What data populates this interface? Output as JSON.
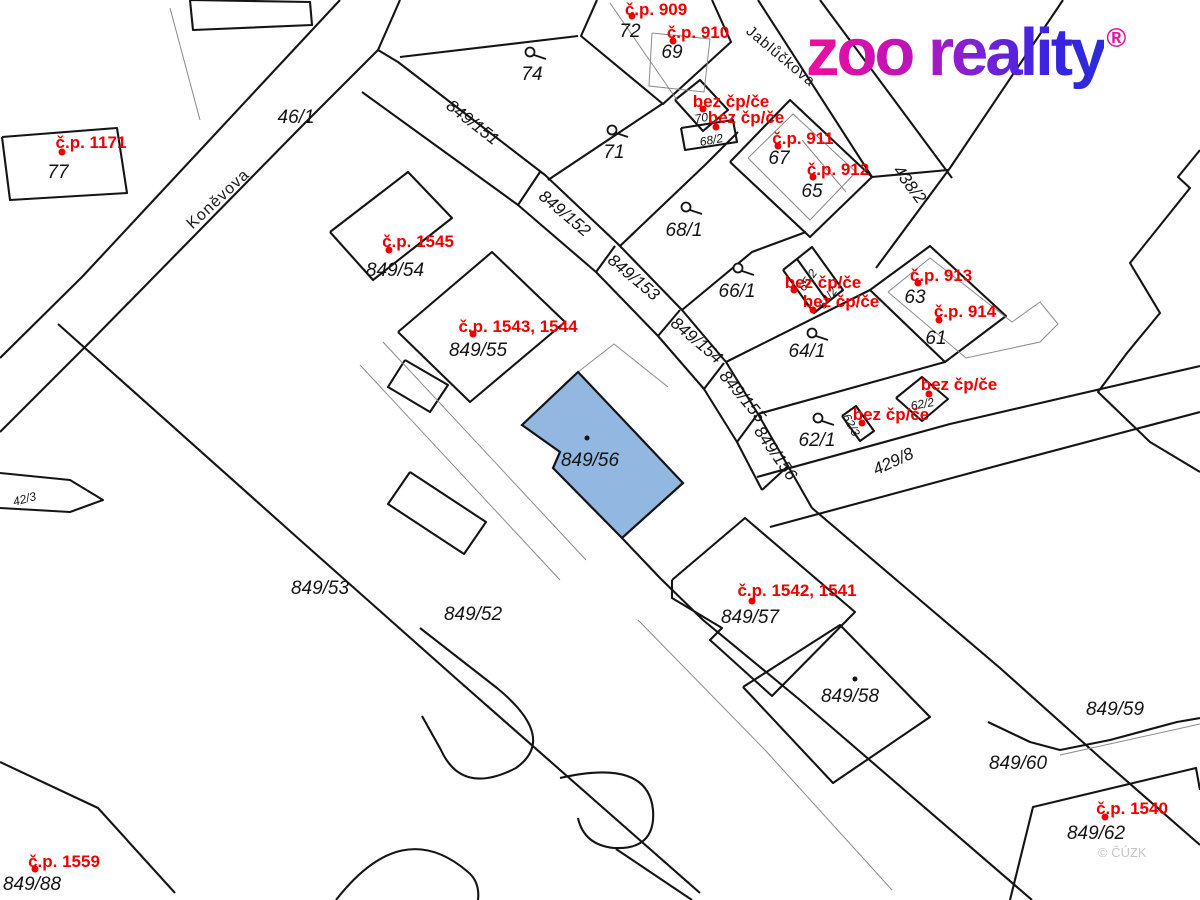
{
  "logo": {
    "text": "zoo reality",
    "reg": "®"
  },
  "watermark": "© ČÚZK",
  "highlight": {
    "label": "849/56",
    "color": "#92b7e0",
    "points": [
      [
        578,
        372
      ],
      [
        683,
        483
      ],
      [
        622,
        538
      ],
      [
        553,
        468
      ],
      [
        560,
        452
      ],
      [
        522,
        425
      ]
    ],
    "dot": [
      587,
      438
    ],
    "label_pos": [
      590,
      459
    ]
  },
  "streets": [
    {
      "name": "Koněvova",
      "x": 218,
      "y": 199,
      "rot": -43,
      "size": 16
    },
    {
      "name": "Jablůčkova",
      "x": 781,
      "y": 56,
      "rot": 40,
      "size": 15
    }
  ],
  "parcel_labels": [
    {
      "t": "77",
      "x": 58,
      "y": 172
    },
    {
      "t": "46/1",
      "x": 296,
      "y": 117
    },
    {
      "t": "74",
      "x": 532,
      "y": 74
    },
    {
      "t": "72",
      "x": 630,
      "y": 31
    },
    {
      "t": "69",
      "x": 672,
      "y": 52
    },
    {
      "t": "71",
      "x": 614,
      "y": 152
    },
    {
      "t": "68/1",
      "x": 684,
      "y": 230
    },
    {
      "t": "66/1",
      "x": 737,
      "y": 291
    },
    {
      "t": "67",
      "x": 779,
      "y": 158
    },
    {
      "t": "65",
      "x": 812,
      "y": 191
    },
    {
      "t": "64/1",
      "x": 807,
      "y": 351
    },
    {
      "t": "63",
      "x": 915,
      "y": 297
    },
    {
      "t": "61",
      "x": 936,
      "y": 338
    },
    {
      "t": "62/1",
      "x": 817,
      "y": 440
    },
    {
      "t": "849/54",
      "x": 395,
      "y": 270
    },
    {
      "t": "849/55",
      "x": 478,
      "y": 350
    },
    {
      "t": "849/53",
      "x": 320,
      "y": 588
    },
    {
      "t": "849/52",
      "x": 473,
      "y": 614
    },
    {
      "t": "849/57",
      "x": 750,
      "y": 617
    },
    {
      "t": "849/58",
      "x": 850,
      "y": 696
    },
    {
      "t": "849/59",
      "x": 1115,
      "y": 709
    },
    {
      "t": "849/60",
      "x": 1018,
      "y": 763
    },
    {
      "t": "849/62",
      "x": 1096,
      "y": 833
    },
    {
      "t": "849/88",
      "x": 32,
      "y": 884
    },
    {
      "t": "849/151",
      "x": 473,
      "y": 122,
      "rot": 38,
      "size": 17
    },
    {
      "t": "849/152",
      "x": 565,
      "y": 213,
      "rot": 40,
      "size": 17
    },
    {
      "t": "849/153",
      "x": 634,
      "y": 277,
      "rot": 40,
      "size": 17
    },
    {
      "t": "849/154",
      "x": 697,
      "y": 340,
      "rot": 40,
      "size": 17
    },
    {
      "t": "849/155",
      "x": 743,
      "y": 396,
      "rot": 50,
      "size": 17
    },
    {
      "t": "849/156",
      "x": 776,
      "y": 453,
      "rot": 55,
      "size": 17
    },
    {
      "t": "438/2",
      "x": 910,
      "y": 184,
      "rot": 53,
      "size": 17
    },
    {
      "t": "429/8",
      "x": 893,
      "y": 461,
      "rot": -25,
      "size": 17
    },
    {
      "t": "70",
      "x": 701,
      "y": 116,
      "rot": -10,
      "size": 12
    },
    {
      "t": "68/2",
      "x": 711,
      "y": 138,
      "rot": -10,
      "size": 12
    },
    {
      "t": "65/2",
      "x": 806,
      "y": 279,
      "rot": -55,
      "size": 12
    },
    {
      "t": "64/2",
      "x": 826,
      "y": 297,
      "rot": -55,
      "size": 12
    },
    {
      "t": "62/2",
      "x": 922,
      "y": 402,
      "rot": -10,
      "size": 12
    },
    {
      "t": "62/3",
      "x": 853,
      "y": 424,
      "rot": 62,
      "size": 12
    },
    {
      "t": "42/3",
      "x": 24,
      "y": 497,
      "rot": -15,
      "size": 12
    }
  ],
  "red_labels": [
    {
      "t": "č.p. 1171",
      "x": 91,
      "y": 142,
      "dx": 62,
      "dy": 152
    },
    {
      "t": "č.p. 909",
      "x": 656,
      "y": 9,
      "dx": 632,
      "dy": 16
    },
    {
      "t": "č.p. 910",
      "x": 698,
      "y": 32,
      "dx": 673,
      "dy": 41
    },
    {
      "t": "bez čp/če",
      "x": 731,
      "y": 101,
      "dx": 703,
      "dy": 109
    },
    {
      "t": "bez čp/če",
      "x": 746,
      "y": 117,
      "dx": 716,
      "dy": 127
    },
    {
      "t": "č.p. 911",
      "x": 803,
      "y": 138,
      "dx": 778,
      "dy": 146
    },
    {
      "t": "č.p. 912",
      "x": 838,
      "y": 169,
      "dx": 813,
      "dy": 177
    },
    {
      "t": "č.p. 913",
      "x": 941,
      "y": 275,
      "dx": 918,
      "dy": 283
    },
    {
      "t": "č.p. 914",
      "x": 965,
      "y": 311,
      "dx": 939,
      "dy": 320
    },
    {
      "t": "bez čp/če",
      "x": 823,
      "y": 282,
      "dx": 794,
      "dy": 290
    },
    {
      "t": "bez čp/če",
      "x": 841,
      "y": 301,
      "dx": 813,
      "dy": 310
    },
    {
      "t": "bez čp/če",
      "x": 959,
      "y": 384,
      "dx": 929,
      "dy": 394
    },
    {
      "t": "bez čp/če",
      "x": 891,
      "y": 414,
      "dx": 862,
      "dy": 423
    },
    {
      "t": "č.p. 1545",
      "x": 418,
      "y": 241,
      "dx": 389,
      "dy": 250
    },
    {
      "t": "č.p. 1543, 1544",
      "x": 518,
      "y": 326,
      "dx": 473,
      "dy": 334
    },
    {
      "t": "č.p. 1542, 1541",
      "x": 797,
      "y": 590,
      "dx": 752,
      "dy": 601
    },
    {
      "t": "č.p. 1540",
      "x": 1132,
      "y": 808,
      "dx": 1105,
      "dy": 817
    },
    {
      "t": "č.p. 1559",
      "x": 64,
      "y": 861,
      "dx": 35,
      "dy": 869
    }
  ],
  "map": {
    "thick": [
      [
        [
          340,
          0
        ],
        [
          82,
          277
        ],
        [
          0,
          358
        ]
      ],
      [
        [
          400,
          0
        ],
        [
          378,
          50
        ],
        [
          300,
          128
        ],
        [
          92,
          340
        ],
        [
          0,
          432
        ]
      ],
      [
        [
          378,
          50
        ],
        [
          398,
          62
        ],
        [
          545,
          175
        ],
        [
          618,
          244
        ],
        [
          682,
          310
        ],
        [
          726,
          362
        ],
        [
          758,
          414
        ],
        [
          788,
          466
        ],
        [
          812,
          508
        ]
      ],
      [
        [
          362,
          92
        ],
        [
          518,
          205
        ],
        [
          596,
          272
        ],
        [
          658,
          336
        ],
        [
          704,
          389
        ],
        [
          737,
          442
        ],
        [
          762,
          490
        ]
      ],
      [
        [
          540,
          172
        ],
        [
          518,
          205
        ]
      ],
      [
        [
          615,
          246
        ],
        [
          596,
          272
        ]
      ],
      [
        [
          680,
          310
        ],
        [
          658,
          336
        ]
      ],
      [
        [
          724,
          363
        ],
        [
          704,
          389
        ]
      ],
      [
        [
          757,
          415
        ],
        [
          737,
          442
        ]
      ],
      [
        [
          788,
          466
        ],
        [
          762,
          490
        ]
      ],
      [
        [
          400,
          57
        ],
        [
          578,
          36
        ]
      ],
      [
        [
          548,
          180
        ],
        [
          662,
          104
        ]
      ],
      [
        [
          620,
          246
        ],
        [
          705,
          165
        ],
        [
          738,
          132
        ]
      ],
      [
        [
          682,
          310
        ],
        [
          752,
          252
        ],
        [
          806,
          232
        ]
      ],
      [
        [
          726,
          362
        ],
        [
          870,
          290
        ]
      ],
      [
        [
          758,
          414
        ],
        [
          945,
          362
        ]
      ],
      [
        [
          757,
          477
        ],
        [
          950,
          424
        ],
        [
          1200,
          366
        ]
      ],
      [
        [
          770,
          527
        ],
        [
          1000,
          465
        ],
        [
          1200,
          412
        ]
      ],
      [
        [
          812,
          508
        ],
        [
          900,
          583
        ],
        [
          1000,
          668
        ],
        [
          1105,
          762
        ],
        [
          1200,
          845
        ]
      ],
      [
        [
          870,
          290
        ],
        [
          930,
          246
        ],
        [
          1006,
          316
        ],
        [
          945,
          362
        ],
        [
          870,
          290
        ]
      ],
      [
        [
          730,
          162
        ],
        [
          790,
          100
        ],
        [
          872,
          177
        ],
        [
          810,
          237
        ],
        [
          730,
          162
        ]
      ],
      [
        [
          675,
          100
        ],
        [
          700,
          80
        ],
        [
          728,
          110
        ],
        [
          703,
          131
        ],
        [
          675,
          100
        ]
      ],
      [
        [
          681,
          128
        ],
        [
          733,
          120
        ],
        [
          737,
          142
        ],
        [
          685,
          150
        ],
        [
          681,
          128
        ]
      ],
      [
        [
          783,
          270
        ],
        [
          812,
          247
        ],
        [
          843,
          290
        ],
        [
          814,
          313
        ],
        [
          783,
          270
        ]
      ],
      [
        [
          797,
          259
        ],
        [
          828,
          302
        ]
      ],
      [
        [
          896,
          398
        ],
        [
          922,
          377
        ],
        [
          948,
          399
        ],
        [
          922,
          421
        ],
        [
          896,
          398
        ]
      ],
      [
        [
          842,
          416
        ],
        [
          856,
          406
        ],
        [
          874,
          431
        ],
        [
          860,
          441
        ],
        [
          842,
          416
        ]
      ],
      [
        [
          597,
          0
        ],
        [
          581,
          36
        ],
        [
          663,
          104
        ],
        [
          731,
          42
        ],
        [
          712,
          0
        ]
      ],
      [
        [
          2,
          137
        ],
        [
          117,
          128
        ],
        [
          127,
          193
        ],
        [
          10,
          200
        ],
        [
          2,
          137
        ]
      ],
      [
        [
          190,
          0
        ],
        [
          310,
          2
        ],
        [
          312,
          25
        ],
        [
          193,
          30
        ],
        [
          190,
          0
        ]
      ],
      [
        [
          758,
          0
        ],
        [
          872,
          177
        ]
      ],
      [
        [
          820,
          0
        ],
        [
          952,
          178
        ]
      ],
      [
        [
          1063,
          0
        ],
        [
          950,
          168
        ],
        [
          876,
          268
        ]
      ],
      [
        [
          872,
          177
        ],
        [
          948,
          170
        ]
      ],
      [
        [
          330,
          232
        ],
        [
          408,
          172
        ],
        [
          452,
          218
        ],
        [
          373,
          280
        ],
        [
          330,
          232
        ]
      ],
      [
        [
          398,
          332
        ],
        [
          492,
          252
        ],
        [
          565,
          322
        ],
        [
          470,
          402
        ],
        [
          398,
          332
        ]
      ],
      [
        [
          672,
          580
        ],
        [
          745,
          518
        ],
        [
          855,
          612
        ],
        [
          772,
          696
        ],
        [
          710,
          640
        ],
        [
          722,
          628
        ],
        [
          672,
          598
        ],
        [
          672,
          580
        ]
      ],
      [
        [
          743,
          687
        ],
        [
          840,
          625
        ],
        [
          930,
          717
        ],
        [
          833,
          783
        ],
        [
          743,
          687
        ]
      ],
      [
        [
          622,
          538
        ],
        [
          660,
          578
        ],
        [
          703,
          620
        ],
        [
          800,
          700
        ],
        [
          1032,
          900
        ]
      ],
      [
        [
          58,
          324
        ],
        [
          300,
          540
        ],
        [
          460,
          682
        ],
        [
          700,
          893
        ]
      ],
      [
        [
          0,
          473
        ],
        [
          70,
          480
        ],
        [
          103,
          500
        ],
        [
          70,
          512
        ],
        [
          0,
          508
        ]
      ],
      [
        [
          0,
          762
        ],
        [
          98,
          808
        ],
        [
          175,
          893
        ]
      ],
      [
        [
          988,
          722
        ],
        [
          1030,
          742
        ],
        [
          1060,
          750
        ],
        [
          1110,
          740
        ],
        [
          1177,
          722
        ],
        [
          1200,
          718
        ]
      ],
      [
        [
          1010,
          900
        ],
        [
          1033,
          807
        ],
        [
          1196,
          768
        ],
        [
          1200,
          790
        ]
      ],
      [
        [
          1200,
          150
        ],
        [
          1178,
          177
        ],
        [
          1190,
          188
        ],
        [
          1130,
          263
        ],
        [
          1160,
          313
        ],
        [
          1127,
          353
        ],
        [
          1098,
          392
        ],
        [
          1150,
          442
        ],
        [
          1200,
          472
        ]
      ],
      [
        [
          405,
          360
        ],
        [
          448,
          385
        ],
        [
          430,
          412
        ],
        [
          388,
          387
        ],
        [
          405,
          360
        ]
      ],
      [
        [
          410,
          472
        ],
        [
          486,
          522
        ],
        [
          464,
          554
        ],
        [
          388,
          504
        ],
        [
          410,
          472
        ]
      ]
    ],
    "paths": [
      "M420,628 L497,688 Q558,738 516,768 Q462,796 441,750 L422,716",
      "M560,778 Q648,758 653,810 Q656,850 614,848 Q584,845 578,818",
      "M616,849 L692,900",
      "M336,900 Q402,815 468,872 Q480,882 478,900"
    ],
    "thin": [
      [
        [
          610,
          3
        ],
        [
          677,
          100
        ]
      ],
      [
        [
          652,
          33
        ],
        [
          710,
          39
        ],
        [
          704,
          92
        ],
        [
          649,
          86
        ],
        [
          652,
          33
        ]
      ],
      [
        [
          748,
          158
        ],
        [
          793,
          114
        ],
        [
          856,
          172
        ],
        [
          810,
          220
        ],
        [
          748,
          158
        ]
      ],
      [
        [
          802,
          140
        ],
        [
          846,
          192
        ]
      ],
      [
        [
          888,
          292
        ],
        [
          930,
          258
        ],
        [
          1012,
          322
        ],
        [
          1040,
          302
        ],
        [
          1058,
          324
        ],
        [
          1040,
          342
        ],
        [
          966,
          358
        ],
        [
          888,
          292
        ]
      ],
      [
        [
          170,
          8
        ],
        [
          200,
          120
        ]
      ],
      [
        [
          383,
          342
        ],
        [
          586,
          560
        ]
      ],
      [
        [
          360,
          365
        ],
        [
          560,
          580
        ]
      ],
      [
        [
          638,
          620
        ],
        [
          765,
          750
        ],
        [
          892,
          890
        ]
      ],
      [
        [
          578,
          372
        ],
        [
          614,
          344
        ],
        [
          668,
          387
        ]
      ],
      [
        [
          1060,
          755
        ],
        [
          1200,
          724
        ]
      ]
    ],
    "circles": [
      [
        530,
        52
      ],
      [
        612,
        130
      ],
      [
        686,
        207
      ],
      [
        738,
        268
      ],
      [
        812,
        333
      ],
      [
        818,
        418
      ]
    ],
    "black_dots": [
      [
        855,
        679
      ]
    ]
  }
}
